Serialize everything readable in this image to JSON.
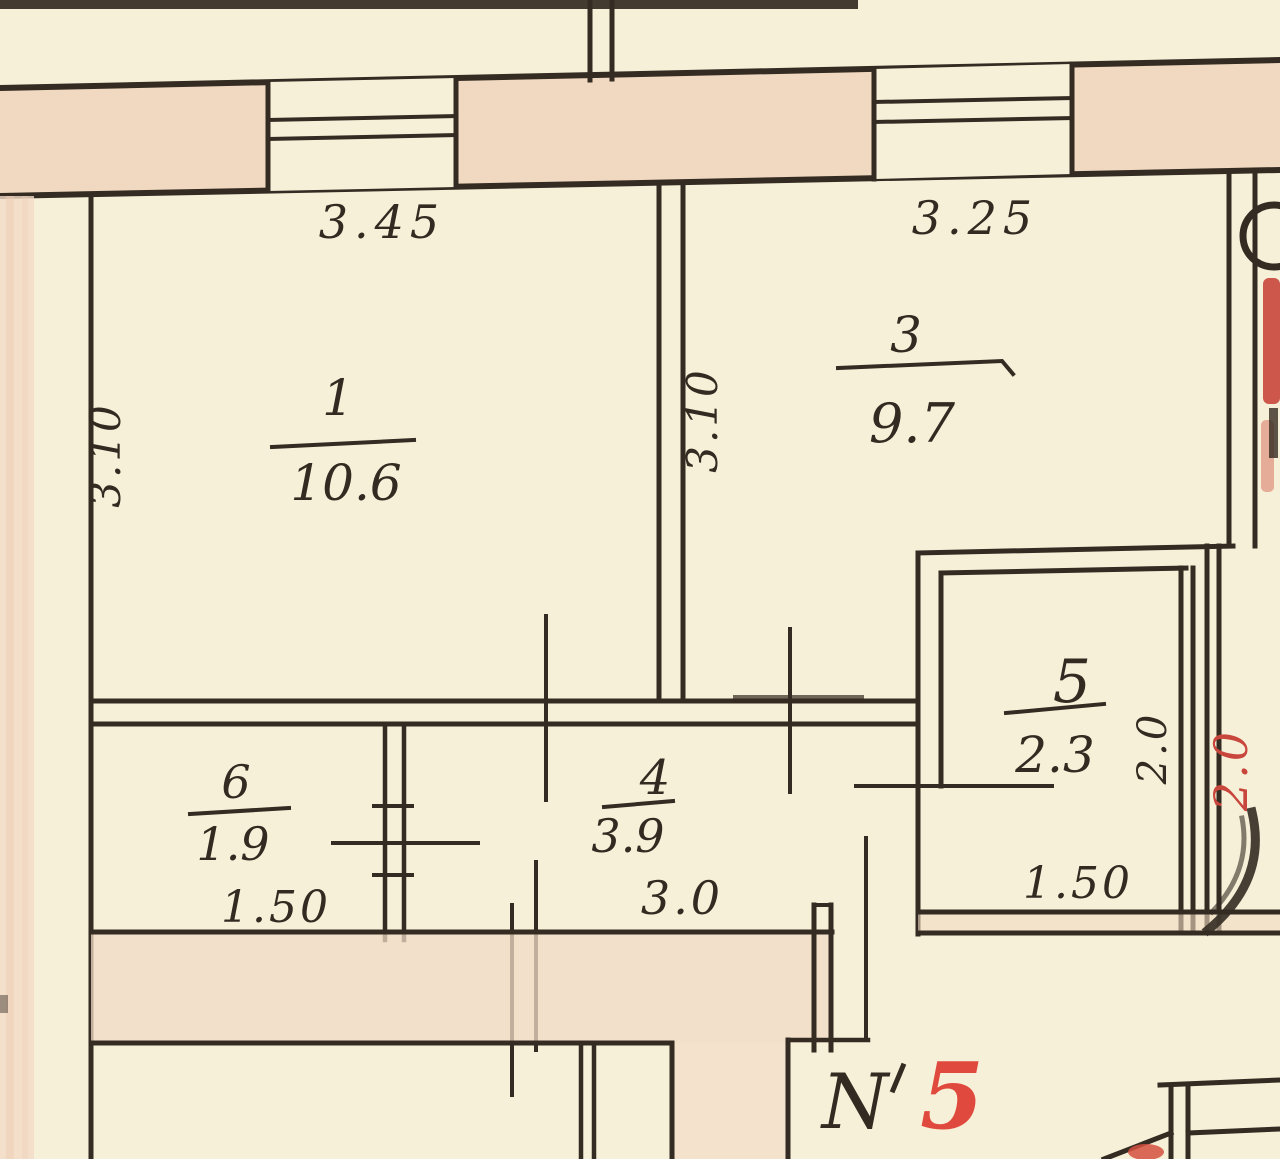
{
  "document": {
    "kind": "scanned apartment floor plan (hand-drawn technical inventory drawing)"
  },
  "colors": {
    "paper": "#f7f0d8",
    "wall_fill": "#f0d9c0",
    "ink": "#342b22",
    "red_pencil": "#c8463c",
    "apartment_number_red": "#e04a3e"
  },
  "rooms": {
    "r1": {
      "number": "1",
      "area": "10.6",
      "width": "3.45",
      "depth": "3.10"
    },
    "r3": {
      "number": "3",
      "area": "9.7",
      "width": "3.25",
      "depth": "3.10"
    },
    "r4": {
      "number": "4",
      "area": "3.9",
      "width": "3.0"
    },
    "r5": {
      "number": "5",
      "area": "2.3",
      "width": "1.50",
      "depth": "2.0",
      "depth_red": "2.0"
    },
    "r6": {
      "number": "6",
      "area": "1.9",
      "width": "1.50"
    }
  },
  "apartment_label": {
    "prefix": "N",
    "number": "5"
  }
}
